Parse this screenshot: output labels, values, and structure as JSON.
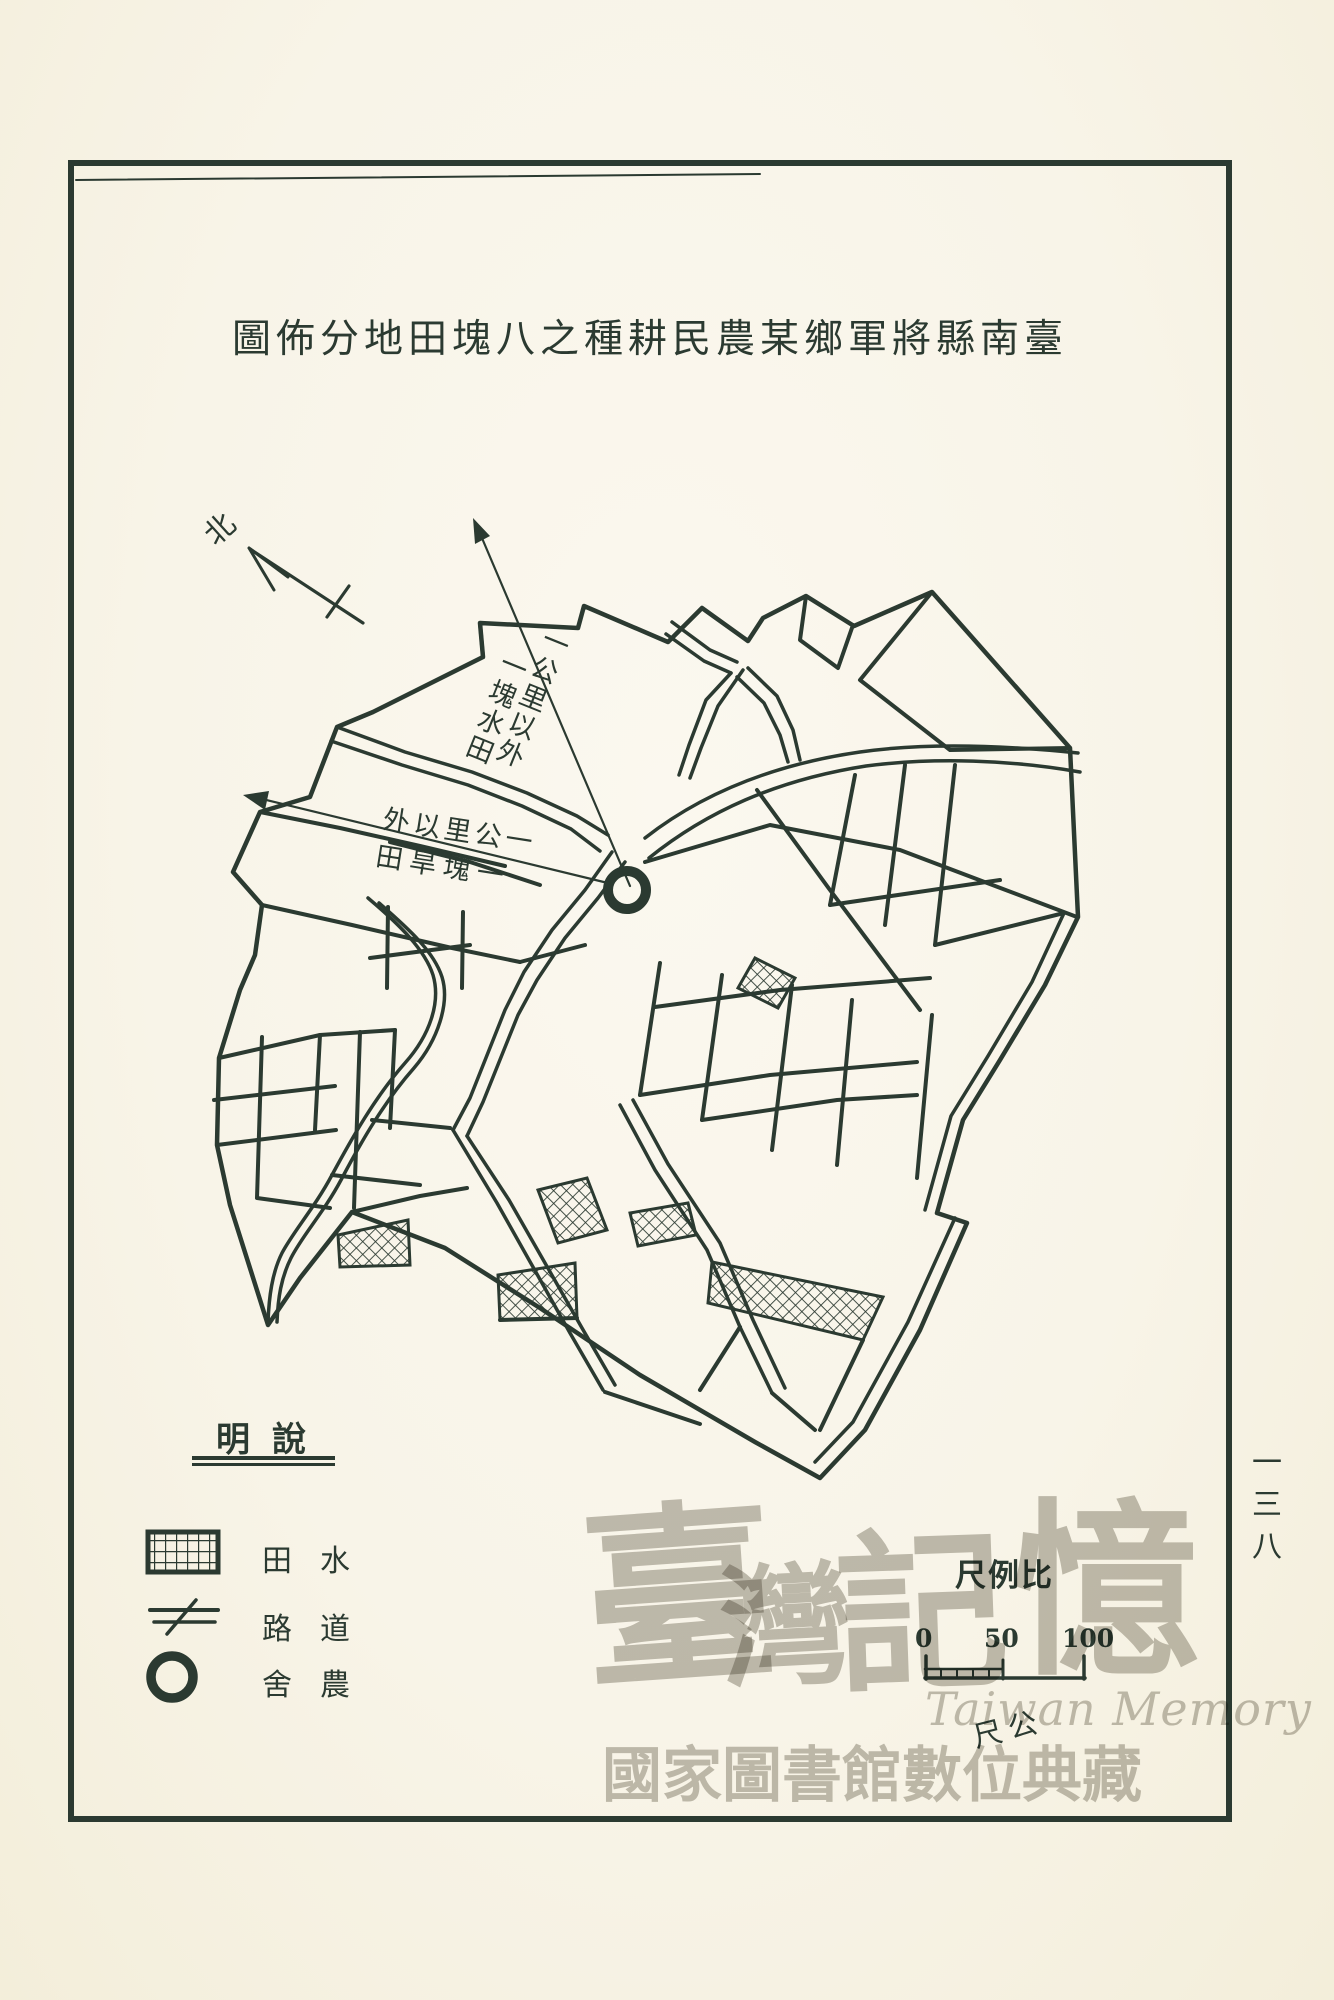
{
  "page": {
    "paper_color": "#f8f4e8",
    "ink_color": "#2b3a31",
    "watermark_color": "#8f8b7f"
  },
  "title": "圖佈分地田塊八之種耕民農某鄉軍將縣南臺",
  "compass_label": "北",
  "map_labels": {
    "northeast_arrow": {
      "column_right": "一公里以外",
      "column_left": "一塊水田"
    },
    "west_arrow": {
      "row_top": "外以里公一",
      "row_bottom": "田旱塊一"
    }
  },
  "legend": {
    "title": "明說",
    "items": [
      {
        "symbol": "paddy-field-swatch",
        "label": "田水"
      },
      {
        "symbol": "road-symbol",
        "label": "路道"
      },
      {
        "symbol": "farmhouse-symbol",
        "label": "舍農"
      }
    ]
  },
  "scale_bar": {
    "title": "尺例比",
    "ticks": [
      "0",
      "50",
      "100"
    ],
    "unit": "尺公"
  },
  "watermark": {
    "chars": [
      "臺",
      "灣",
      "記",
      "憶"
    ],
    "latin": "Taiwan Memory",
    "institution": "國家圖書館數位典藏"
  },
  "page_number": "一三八"
}
